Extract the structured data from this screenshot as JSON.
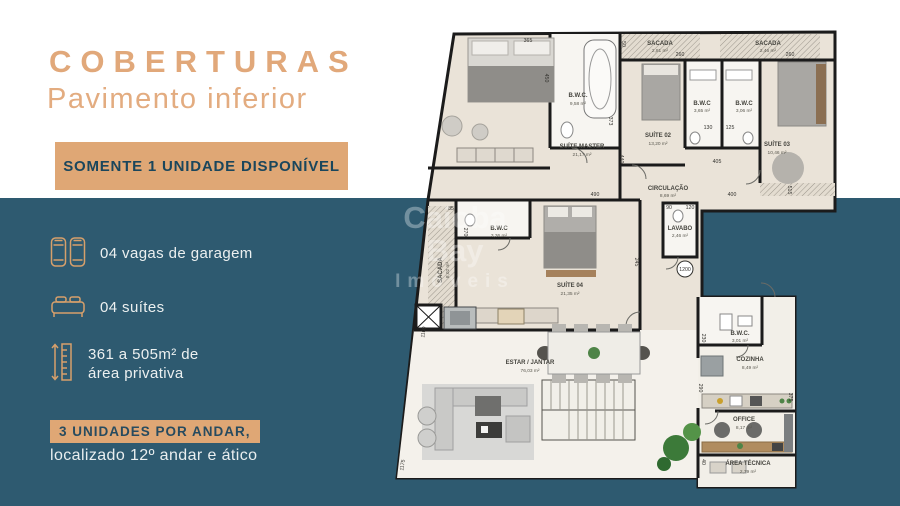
{
  "colors": {
    "teal_background": "#2E5A70",
    "gold_accent": "#DFA775",
    "title_gold": "#E1A87A",
    "banner_text": "#1A465C",
    "plan_floor": "#EAE3D8"
  },
  "header": {
    "title": "COBERTURAS",
    "subtitle": "Pavimento inferior",
    "banner": "SOMENTE 1 UNIDADE DISPONÍVEL"
  },
  "features": [
    {
      "icon": "garage-cars-icon",
      "label": "04 vagas de garagem"
    },
    {
      "icon": "bed-icon",
      "label": "04 suítes"
    },
    {
      "icon": "ruler-icon",
      "label_line1": "361 a 505m² de",
      "label_line2": "área privativa"
    }
  ],
  "footer": {
    "badge": "3 UNIDADES POR ANDAR,",
    "caption": "localizado 12º andar e ático"
  },
  "watermark": {
    "line1": "Caioba",
    "line2": "Bay",
    "line3": "Imóveis"
  },
  "floorplan": {
    "rooms": [
      {
        "name": "SUÍTE MASTER",
        "area": "21,17 m²"
      },
      {
        "name": "B.W.C.",
        "area": "9,58 m²"
      },
      {
        "name": "SACADA",
        "area": "2,81 m²"
      },
      {
        "name": "SUÍTE 02",
        "area": "13,20 m²"
      },
      {
        "name": "B.W.C",
        "area": "3,65 m²"
      },
      {
        "name": "B.W.C",
        "area": "3,06 m²"
      },
      {
        "name": "SACADA",
        "area": "2,46 m²"
      },
      {
        "name": "SUÍTE 03",
        "area": "10,46 m²"
      },
      {
        "name": "CIRCULAÇÃO",
        "area": "8,69 m²"
      },
      {
        "name": "SACADA",
        "area": "8,02 m²"
      },
      {
        "name": "B.W.C",
        "area": "3,36 m²"
      },
      {
        "name": "SUÍTE 04",
        "area": "21,35 m²"
      },
      {
        "name": "LAVABO",
        "area": "2,46 m²"
      },
      {
        "name": "ESTAR / JANTAR",
        "area": "76,03 m²"
      },
      {
        "name": "B.W.C.",
        "area": "3,01 m²"
      },
      {
        "name": "COZINHA",
        "area": "8,49 m²"
      },
      {
        "name": "OFFICE",
        "area": "8,17 m²"
      },
      {
        "name": "ÁREA TÉCNICA",
        "area": "2,79 m²"
      }
    ],
    "dims": [
      "365",
      "450",
      "50",
      "260",
      "260",
      "373",
      "130",
      "125",
      "440",
      "405",
      "400",
      "85",
      "270",
      "245",
      "90",
      "120",
      "230",
      "290",
      "375",
      "40",
      "1100",
      "1175",
      "490",
      "515"
    ],
    "level_marker": "1200"
  }
}
